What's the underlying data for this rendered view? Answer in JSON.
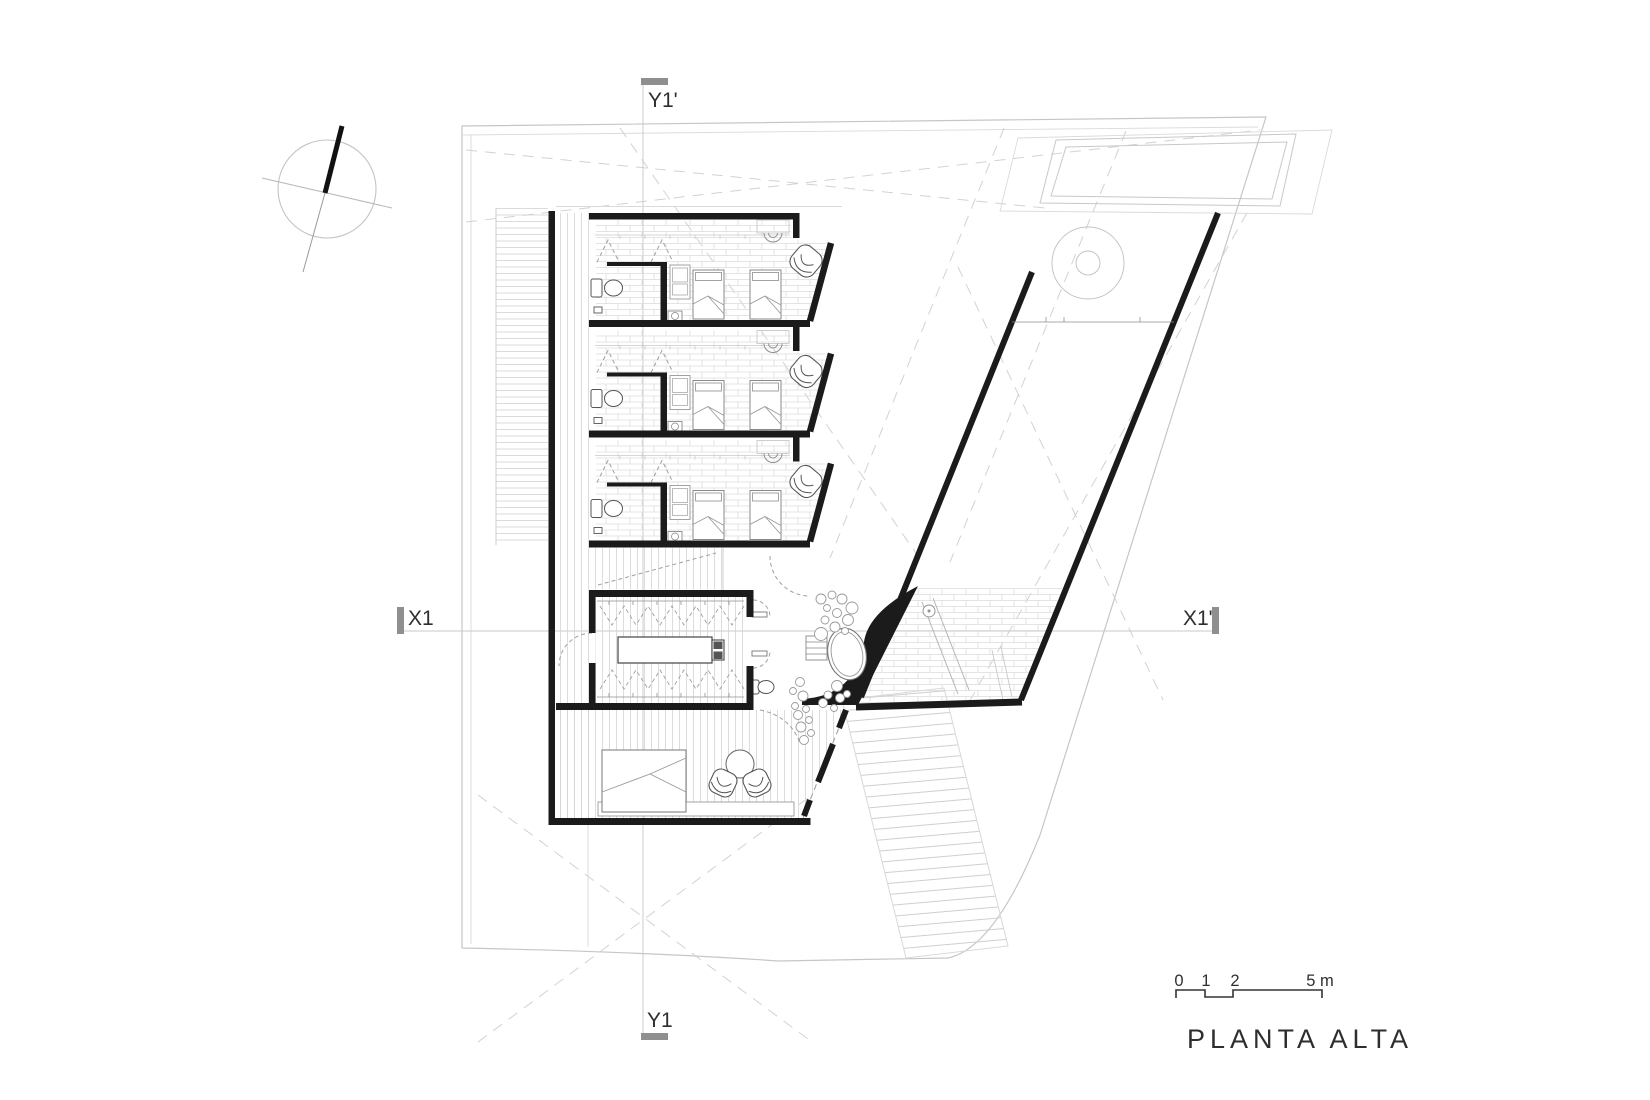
{
  "title": "PLANTA ALTA",
  "section_markers": {
    "top": "Y1'",
    "bottom": "Y1",
    "left": "X1",
    "right": "X1'"
  },
  "scale_bar": {
    "ticks": [
      "0",
      "1",
      "2"
    ],
    "end": "5 m"
  },
  "icons": {
    "compass": "north-arrow"
  },
  "colors": {
    "wall": "#1b1b1b",
    "marker_bar": "#8f8f8f",
    "text": "#2e2e2e",
    "line_light": "#c9c9c9",
    "background": "#ffffff"
  }
}
